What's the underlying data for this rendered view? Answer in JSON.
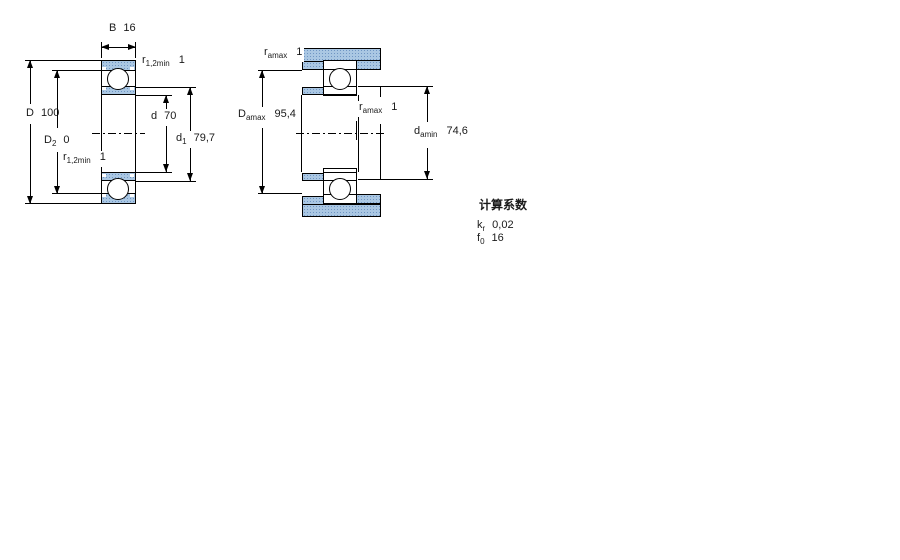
{
  "figure1": {
    "name": "bearing cross-section with boundary dimensions",
    "width_dim": {
      "symbol": "B",
      "value": "16"
    },
    "r_top": {
      "symbol": "r",
      "subscript": "1,2min",
      "value": "1"
    },
    "outer_dia": {
      "symbol": "D",
      "value": "100"
    },
    "recess_dia": {
      "symbol": "D",
      "subscript": "2",
      "value": "0"
    },
    "bore_dia": {
      "symbol": "d",
      "value": "70"
    },
    "shoulder_dia": {
      "symbol": "d",
      "subscript": "1",
      "value": "79,7"
    },
    "r_bottom": {
      "symbol": "r",
      "subscript": "1,2min",
      "value": "1"
    }
  },
  "figure2": {
    "name": "bearing abutment / mounting dimensions",
    "r_top": {
      "symbol": "r",
      "subscript": "amax",
      "value": "1"
    },
    "da_max": {
      "symbol": "D",
      "subscript": "amax",
      "value": "95,4"
    },
    "r_mid": {
      "symbol": "r",
      "subscript": "amax",
      "value": "1"
    },
    "da_min": {
      "symbol": "d",
      "subscript": "amin",
      "value": "74,6"
    }
  },
  "calculation_factors": {
    "heading": "计算系数",
    "rows": [
      {
        "symbol": "k",
        "subscript": "r",
        "value": "0,02"
      },
      {
        "symbol": "f",
        "subscript": "0",
        "value": "16"
      }
    ]
  },
  "colors": {
    "hb": "#aac7e3",
    "hd": "#6f95c3",
    "ln": "#000000"
  }
}
